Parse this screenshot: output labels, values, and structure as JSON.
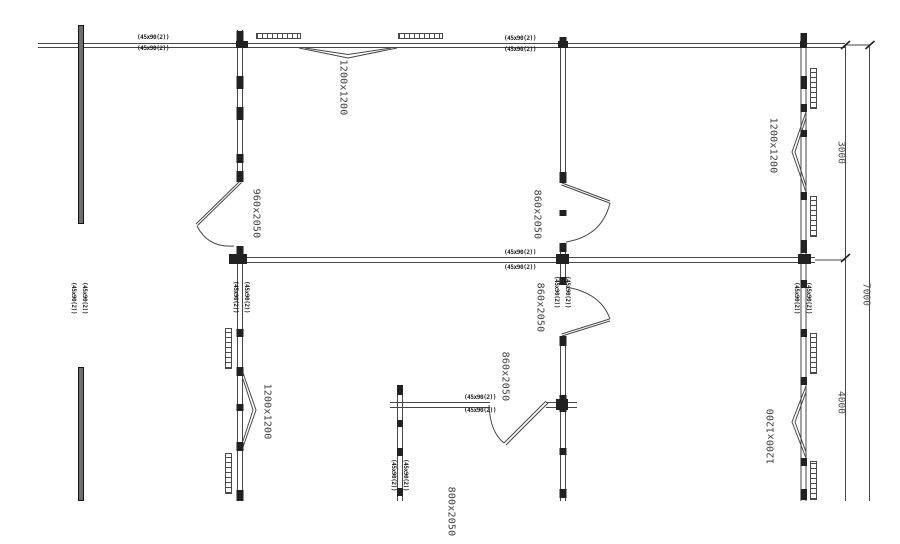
{
  "drawing": {
    "windows": {
      "top": "1200x1200",
      "left": "1200x1200",
      "right_top": "1200x1200",
      "right_bottom": "1200x1200"
    },
    "doors": {
      "left": "960x2050",
      "middle_top": "860x2050",
      "middle_lower": "860x2050",
      "bottom": "860x2050",
      "bottom_cut": "800x2050"
    },
    "dimensions": {
      "right_upper": "3000",
      "right_lower": "4000",
      "right_total": "7000"
    },
    "wall_note": "(45x90(2))",
    "colors": {
      "line": "#474747",
      "stud": "#222222",
      "text": "#3f3f3f",
      "background": "#ffffff"
    }
  }
}
